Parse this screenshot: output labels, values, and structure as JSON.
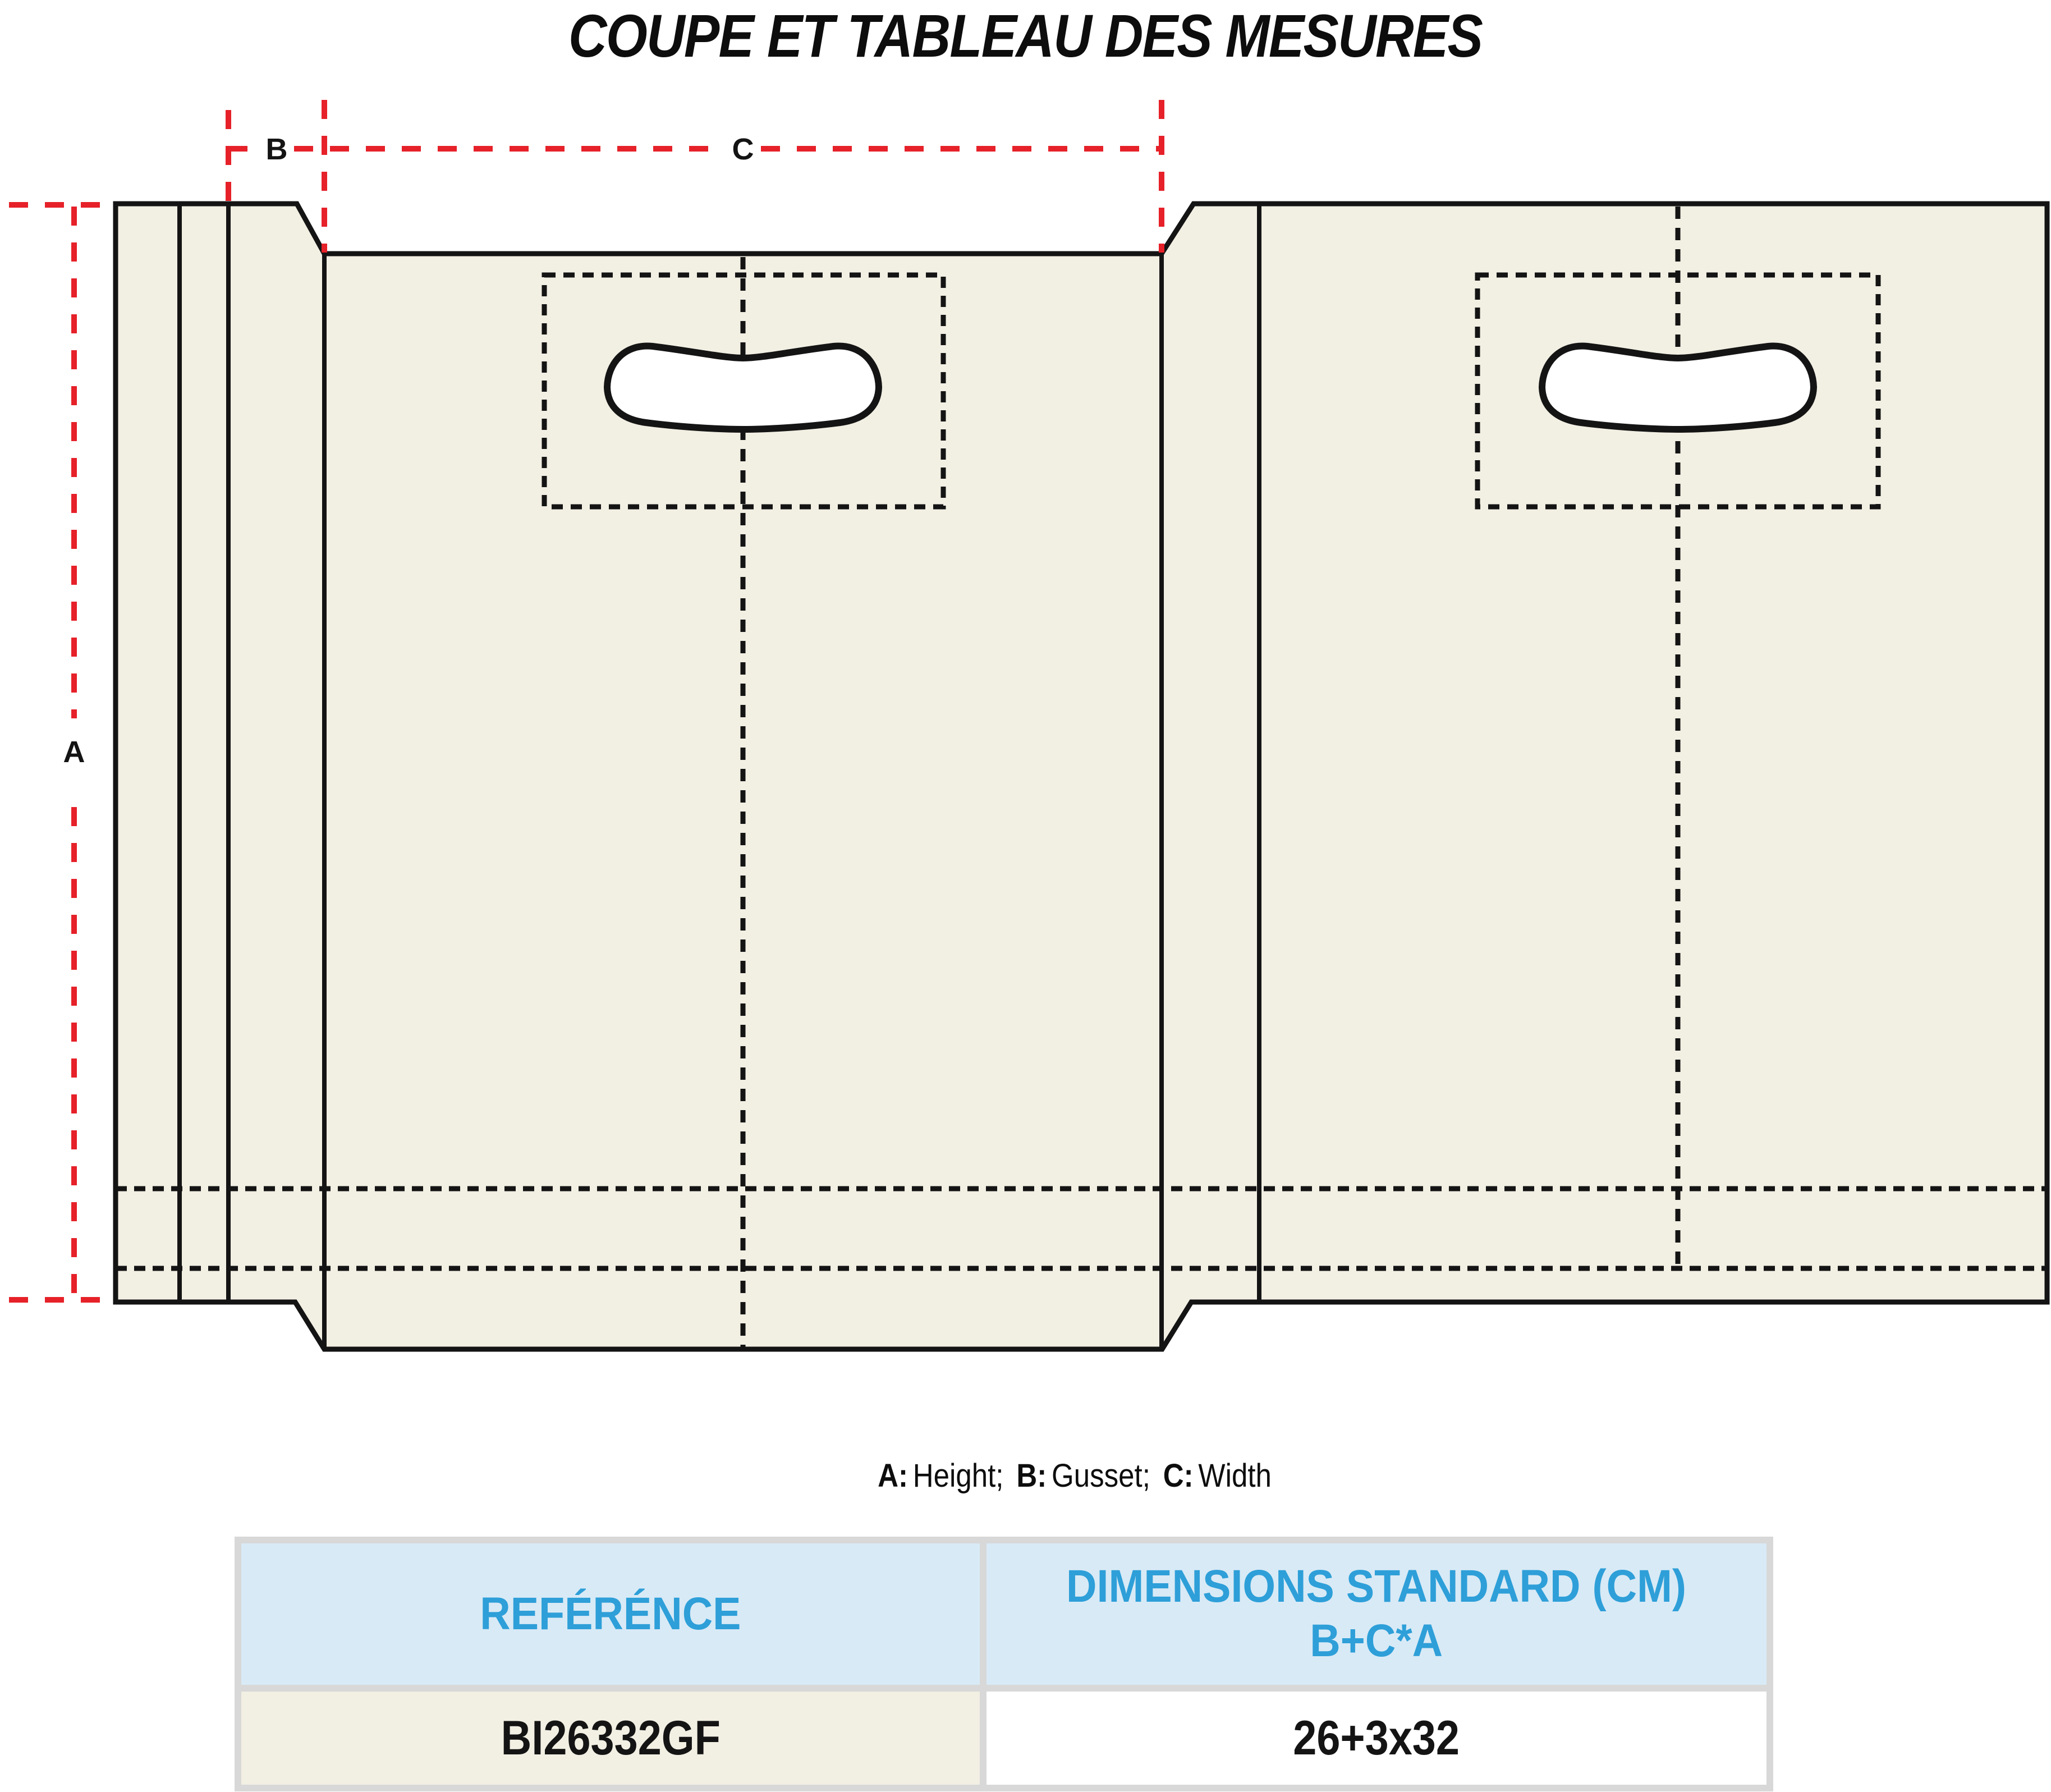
{
  "title": "COUPE ET TABLEAU DES MESURES",
  "diagram": {
    "dim_labels": {
      "a": "A",
      "b": "B",
      "c": "C"
    },
    "colors": {
      "bag_fill": "#F2EFE3",
      "outline_black": "#141414",
      "dimension_red": "#E62129"
    }
  },
  "legend": {
    "a_key": "A:",
    "a_value": "Height;",
    "b_key": "B:",
    "b_value": "Gusset;",
    "c_key": "C:",
    "c_value": "Width"
  },
  "table": {
    "header": {
      "reference": "REFÉRÉNCE",
      "dimensions_line1": "DIMENSIONS STANDARD (CM)",
      "dimensions_line2": "B+C*A"
    },
    "rows": [
      {
        "reference": "BI26332GF",
        "dimensions": "26+3x32"
      }
    ],
    "colors": {
      "header_bg": "#D8EAF6",
      "header_text": "#2E9FD8",
      "reference_cell_bg": "#F2EFE3",
      "dimensions_cell_bg": "#FFFFFF",
      "border": "#D8D8D8",
      "value_text": "#141414"
    }
  }
}
